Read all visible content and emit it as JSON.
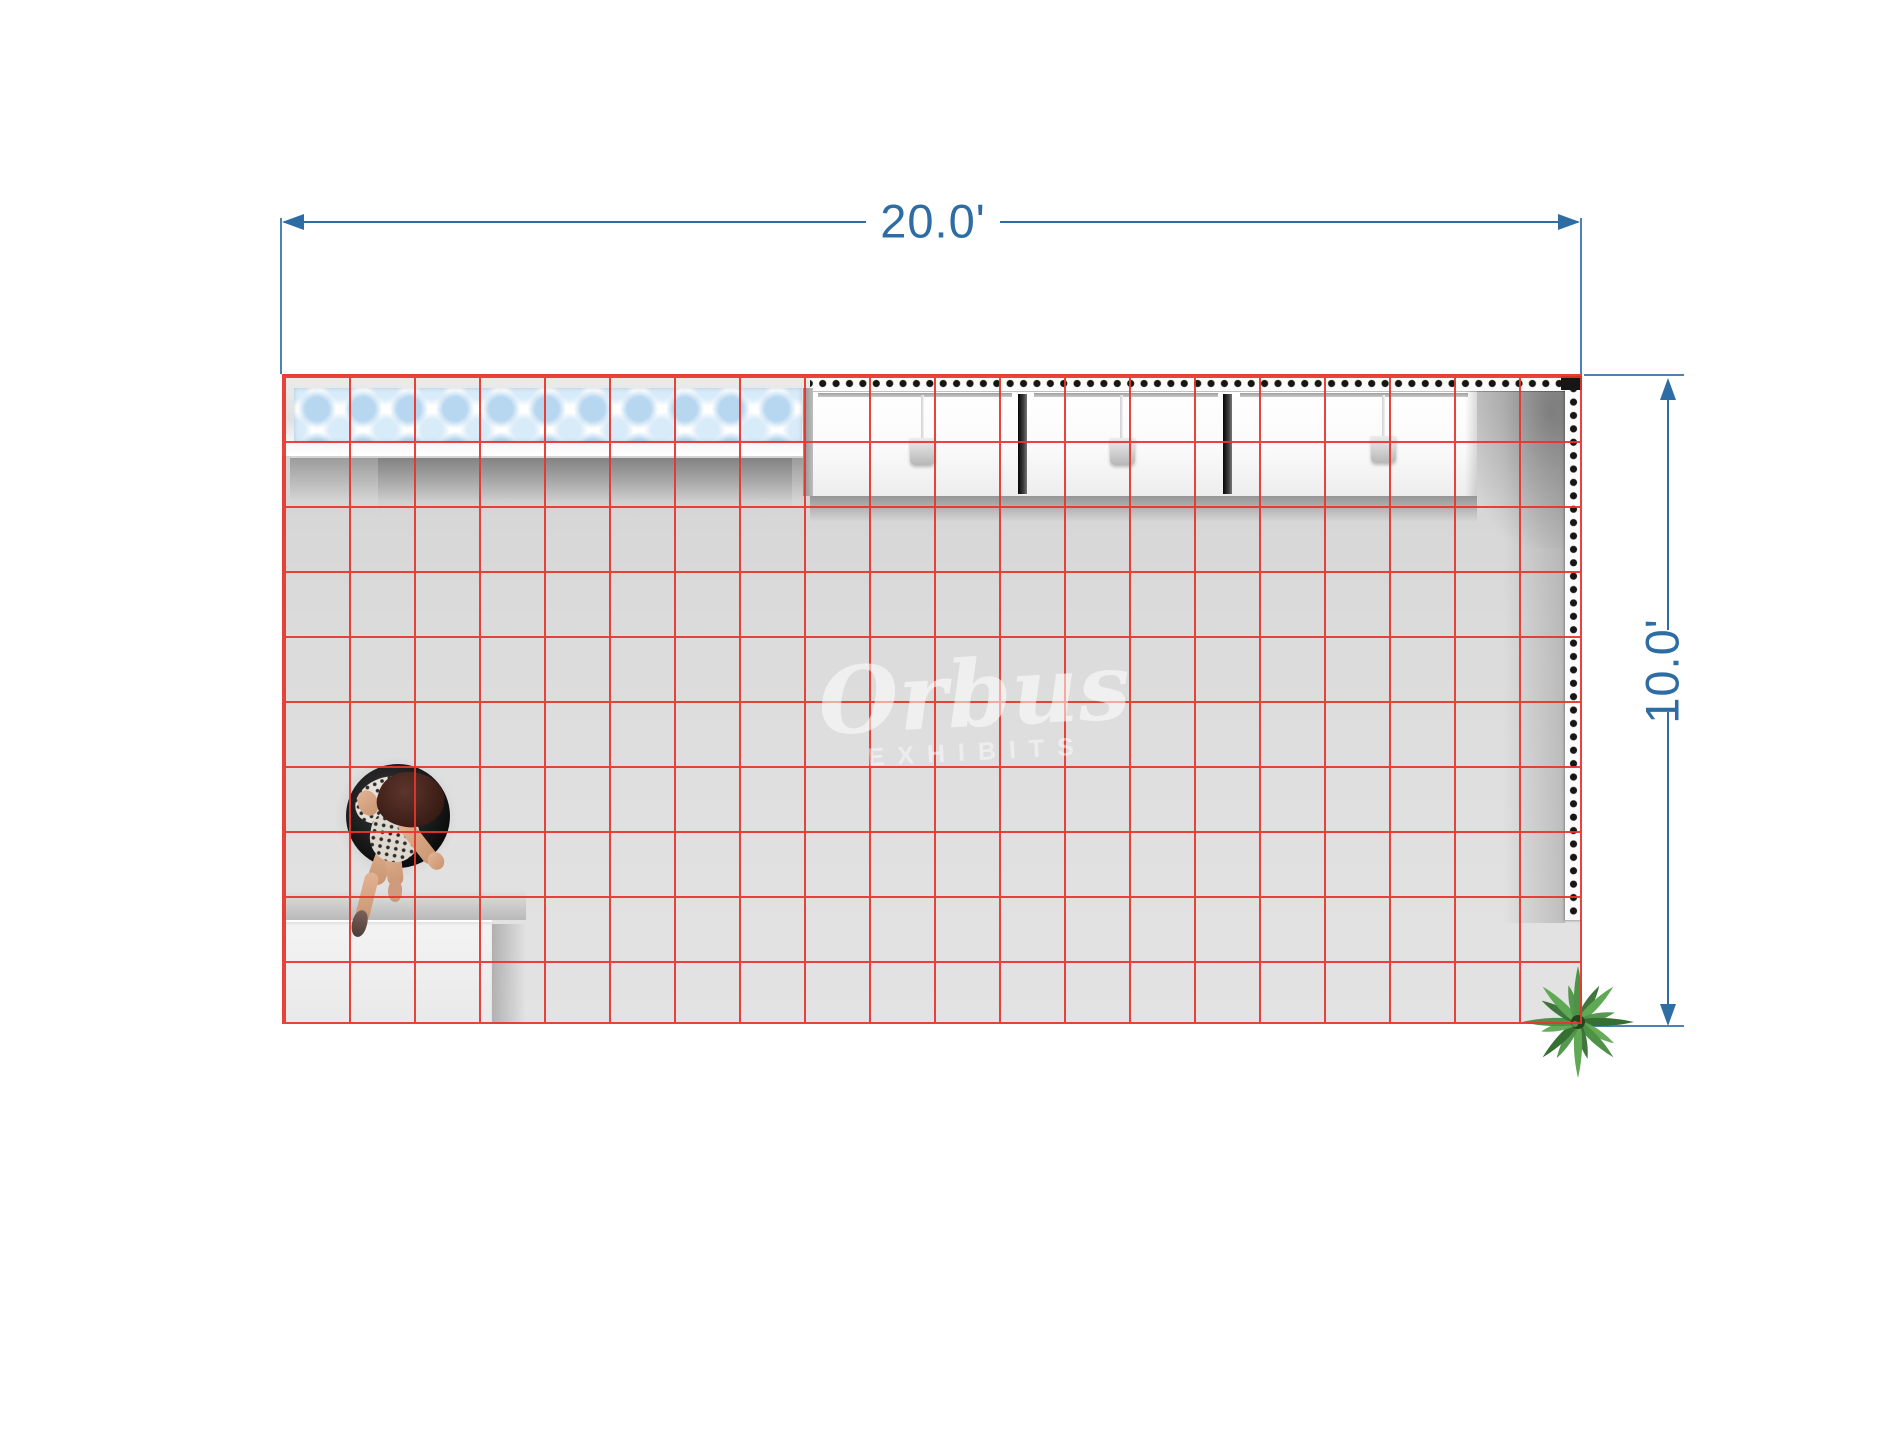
{
  "scene": {
    "description": "Top-down rendering of a 20ft x 10ft trade show booth floor plan with red layout grid",
    "furniture": [
      "backlit-polka-dot-counter",
      "storage-cabinet-run",
      "dotted-seg-wall-top",
      "dotted-seg-wall-right",
      "white-counter-cube",
      "seated-person-on-stool",
      "potted-plant"
    ]
  },
  "dimensions": {
    "width_label": "20.0'",
    "height_label": "10.0'"
  },
  "watermark": {
    "script": "Orbus",
    "caption": "EXHIBITS"
  },
  "grid": {
    "cols": 20,
    "rows": 10
  },
  "colors": {
    "accent": "#2e6da4",
    "gridred": "#e8352c",
    "floor": "#d9d9d9",
    "dotblue": "#b7d7f0",
    "dotbluelight": "#d8ebf9",
    "walldot": "#161616",
    "green1": "#4e9248",
    "green2": "#356f31",
    "green3": "#5fa854"
  }
}
